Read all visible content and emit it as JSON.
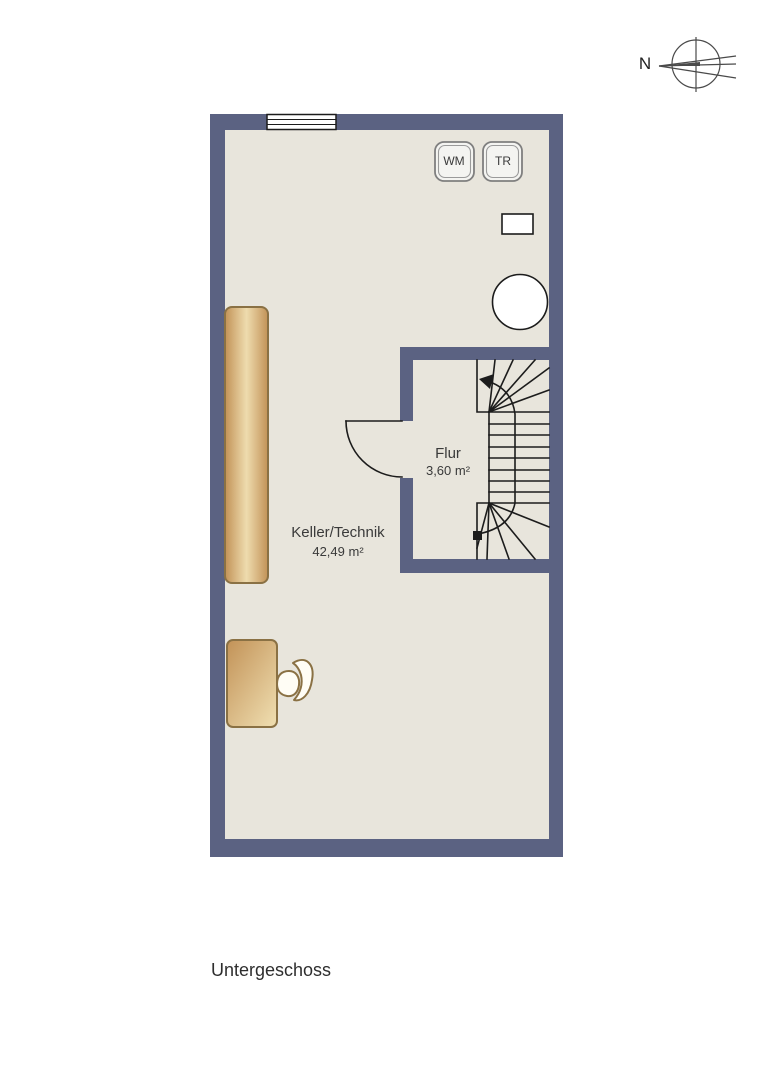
{
  "colors": {
    "pageBg": "#ffffff",
    "wall": "#5b6282",
    "floor": "#e8e5dc",
    "line": "#1c1c1c",
    "wood1": "#c29257",
    "wood2": "#eedcae",
    "woodBorder": "#8a7144",
    "text": "#3a3a3a"
  },
  "compass": {
    "north_label": "N"
  },
  "floor_title": "Untergeschoss",
  "rooms": {
    "keller": {
      "name": "Keller/Technik",
      "area": "42,49 m²"
    },
    "flur": {
      "name": "Flur",
      "area": "3,60 m²"
    }
  },
  "appliances": {
    "washing_machine": "WM",
    "dryer": "TR"
  }
}
